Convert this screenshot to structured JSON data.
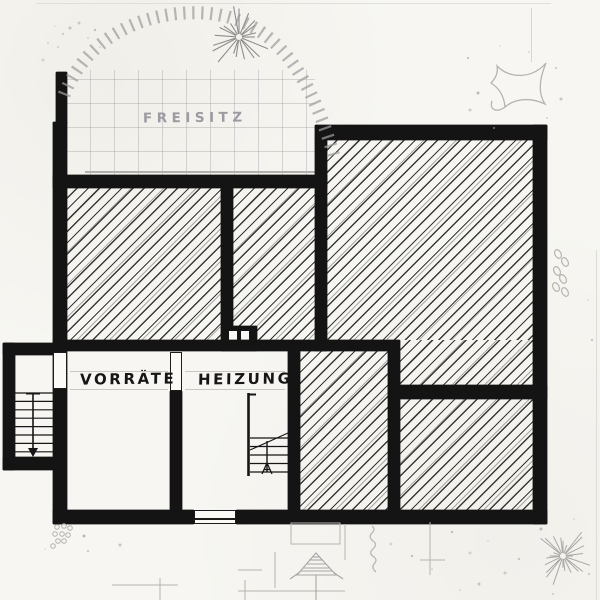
{
  "labels": {
    "freisitz": "FREISITZ",
    "vorraete": "VORRÄTE",
    "heizung": "HEIZUNG"
  },
  "rooms": [
    {
      "name": "freisitz-terrace",
      "label": "FREISITZ",
      "hatched": false,
      "tiled": true
    },
    {
      "name": "upper-left-room",
      "label": "",
      "hatched": true
    },
    {
      "name": "upper-middle-room",
      "label": "",
      "hatched": true
    },
    {
      "name": "large-right-room",
      "label": "",
      "hatched": true
    },
    {
      "name": "vorraete-storage-room",
      "label": "VORRÄTE",
      "hatched": false
    },
    {
      "name": "heizung-boiler-room",
      "label": "HEIZUNG",
      "hatched": false
    },
    {
      "name": "narrow-lower-room",
      "label": "",
      "hatched": true
    },
    {
      "name": "lower-right-room",
      "label": "",
      "hatched": true
    }
  ],
  "features": {
    "exterior_staircase_treads": 8,
    "interior_staircase_treads": 5,
    "chimney_flues": 2,
    "door_openings": 3
  },
  "colors": {
    "paper": "#f7f6f2",
    "wall_ink": "#141414",
    "hatch_ink": "#262626",
    "pencil_gray": "#b9b7b0",
    "label_gray": "#9b9ba1"
  }
}
